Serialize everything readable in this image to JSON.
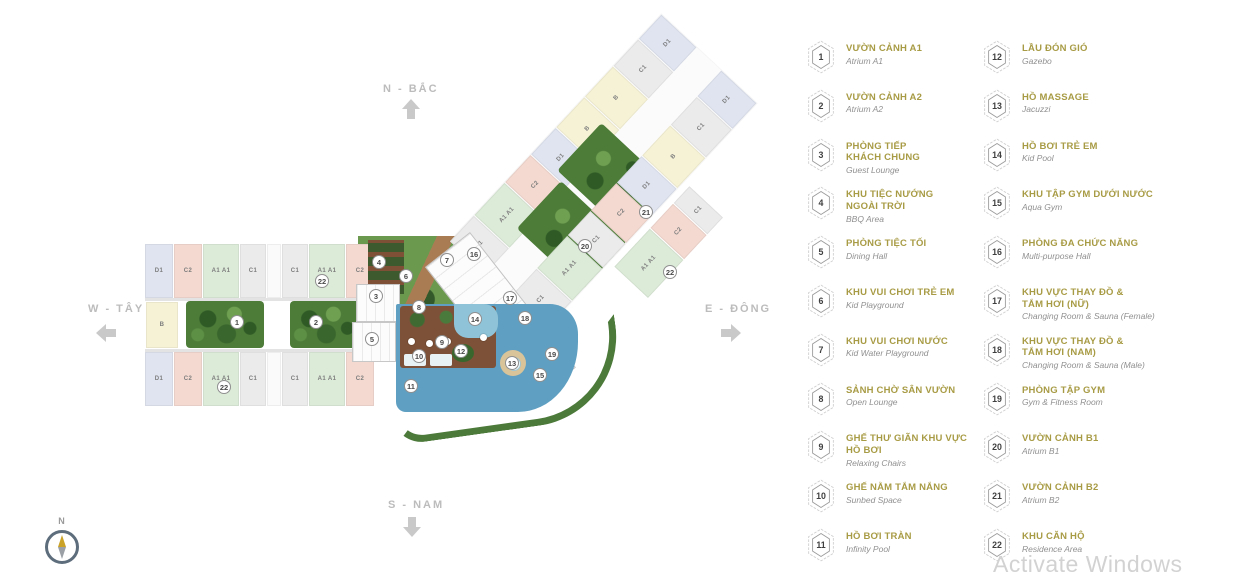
{
  "compass": {
    "north": "N - BẮC",
    "west": "W - TÂY",
    "east": "E - ĐÔNG",
    "south": "S - NAM",
    "rose_label": "N"
  },
  "watermark": {
    "text": "Activate Windows"
  },
  "colors": {
    "accent_gold": "#a89b45",
    "subtitle_gray": "#909090",
    "pool": "#5f9fc1",
    "pool_light": "#8fc3d8",
    "deck_brown": "#7d5137",
    "garden_green": "#6b9a4f",
    "courtyard_green": "#4d7c38",
    "unit_colors": {
      "mint": "#dcead8",
      "pink": "#f3d9d0",
      "gray": "#ebebeb",
      "lavender": "#dfe4f0",
      "yellow": "#f6f2d6",
      "white": "#fafafa"
    }
  },
  "plan": {
    "west_top_units": [
      {
        "l": "D1",
        "c": "lavender",
        "w": 28
      },
      {
        "l": "C2",
        "c": "pink",
        "w": 28
      },
      {
        "l": "A1 A1",
        "c": "mint",
        "w": 36
      },
      {
        "l": "C1",
        "c": "gray",
        "w": 26
      },
      {
        "l": "",
        "c": "white",
        "w": 14
      },
      {
        "l": "C1",
        "c": "gray",
        "w": 26
      },
      {
        "l": "A1 A1",
        "c": "mint",
        "w": 36
      },
      {
        "l": "C2",
        "c": "pink",
        "w": 28
      }
    ],
    "west_bottom_units": [
      {
        "l": "D1",
        "c": "lavender",
        "w": 28
      },
      {
        "l": "C2",
        "c": "pink",
        "w": 28
      },
      {
        "l": "A1 A1",
        "c": "mint",
        "w": 36
      },
      {
        "l": "C1",
        "c": "gray",
        "w": 26
      },
      {
        "l": "",
        "c": "white",
        "w": 14
      },
      {
        "l": "C1",
        "c": "gray",
        "w": 26
      },
      {
        "l": "A1 A1",
        "c": "mint",
        "w": 36
      },
      {
        "l": "C2",
        "c": "pink",
        "w": 28
      }
    ],
    "wing_top_units": [
      {
        "l": "C1",
        "c": "gray",
        "w": 36
      },
      {
        "l": "A1 A1",
        "c": "mint",
        "w": 44
      },
      {
        "l": "C2",
        "c": "pink",
        "w": 38
      },
      {
        "l": "D1",
        "c": "lavender",
        "w": 36
      },
      {
        "l": "B",
        "c": "yellow",
        "w": 42
      },
      {
        "l": "B",
        "c": "yellow",
        "w": 42
      },
      {
        "l": "C1",
        "c": "gray",
        "w": 36
      },
      {
        "l": "D1",
        "c": "lavender",
        "w": 34
      }
    ],
    "wing_bottom_units": [
      {
        "l": "C1",
        "c": "gray",
        "w": 40
      },
      {
        "l": "A1 A1",
        "c": "mint",
        "w": 44
      },
      {
        "l": "C1",
        "c": "gray",
        "w": 34
      },
      {
        "l": "C2",
        "c": "pink",
        "w": 38
      },
      {
        "l": "D1",
        "c": "lavender",
        "w": 36
      },
      {
        "l": "B",
        "c": "yellow",
        "w": 42
      },
      {
        "l": "C1",
        "c": "gray",
        "w": 38
      },
      {
        "l": "D1",
        "c": "lavender",
        "w": 36
      }
    ],
    "wing_extra_units": [
      {
        "l": "A1 A1",
        "c": "mint",
        "w": 52
      },
      {
        "l": "C2",
        "c": "pink",
        "w": 34
      },
      {
        "l": "C1",
        "c": "gray",
        "w": 23
      }
    ],
    "left_cap_label": "B",
    "markers": [
      {
        "n": "1",
        "x": 238,
        "y": 323
      },
      {
        "n": "2",
        "x": 317,
        "y": 323
      },
      {
        "n": "3",
        "x": 377,
        "y": 297
      },
      {
        "n": "4",
        "x": 380,
        "y": 263
      },
      {
        "n": "5",
        "x": 373,
        "y": 340
      },
      {
        "n": "6",
        "x": 407,
        "y": 277
      },
      {
        "n": "7",
        "x": 448,
        "y": 261
      },
      {
        "n": "8",
        "x": 420,
        "y": 308
      },
      {
        "n": "9",
        "x": 443,
        "y": 343
      },
      {
        "n": "10",
        "x": 420,
        "y": 357
      },
      {
        "n": "11",
        "x": 412,
        "y": 387
      },
      {
        "n": "12",
        "x": 462,
        "y": 352
      },
      {
        "n": "13",
        "x": 513,
        "y": 364
      },
      {
        "n": "14",
        "x": 476,
        "y": 320
      },
      {
        "n": "15",
        "x": 541,
        "y": 376
      },
      {
        "n": "16",
        "x": 475,
        "y": 255
      },
      {
        "n": "17",
        "x": 511,
        "y": 299
      },
      {
        "n": "18",
        "x": 526,
        "y": 319
      },
      {
        "n": "19",
        "x": 553,
        "y": 355
      },
      {
        "n": "20",
        "x": 586,
        "y": 247
      },
      {
        "n": "21",
        "x": 647,
        "y": 213
      },
      {
        "n": "22",
        "x": 323,
        "y": 282
      },
      {
        "n": "22",
        "x": 225,
        "y": 388
      },
      {
        "n": "22",
        "x": 671,
        "y": 273
      }
    ]
  },
  "legend": {
    "columns": [
      {
        "items": [
          {
            "num": "1",
            "title_lines": [
              "VƯỜN CẢNH A1"
            ],
            "subtitle": "Atrium A1"
          },
          {
            "num": "2",
            "title_lines": [
              "VƯỜN CẢNH A2"
            ],
            "subtitle": "Atrium A2"
          },
          {
            "num": "3",
            "title_lines": [
              "PHÒNG TIẾP",
              "KHÁCH CHUNG"
            ],
            "subtitle": "Guest Lounge"
          },
          {
            "num": "4",
            "title_lines": [
              "KHU TIỆC NƯỚNG",
              "NGOÀI TRỜI"
            ],
            "subtitle": "BBQ Area"
          },
          {
            "num": "5",
            "title_lines": [
              "PHÒNG TIỆC TỐI"
            ],
            "subtitle": "Dining Hall"
          },
          {
            "num": "6",
            "title_lines": [
              "KHU VUI CHƠI TRẺ EM"
            ],
            "subtitle": "Kid Playground"
          },
          {
            "num": "7",
            "title_lines": [
              "KHU VUI CHƠI NƯỚC"
            ],
            "subtitle": "Kid Water Playground"
          },
          {
            "num": "8",
            "title_lines": [
              "SẢNH CHỜ SÂN VƯỜN"
            ],
            "subtitle": "Open Lounge"
          },
          {
            "num": "9",
            "title_lines": [
              "GHẾ THƯ GIÃN KHU VỰC",
              "HỒ BƠI"
            ],
            "subtitle": "Relaxing Chairs"
          },
          {
            "num": "10",
            "title_lines": [
              "GHẾ NẰM TẮM NẮNG"
            ],
            "subtitle": "Sunbed Space"
          },
          {
            "num": "11",
            "title_lines": [
              "HỒ BƠI TRÀN"
            ],
            "subtitle": "Infinity Pool"
          }
        ]
      },
      {
        "items": [
          {
            "num": "12",
            "title_lines": [
              "LẦU ĐÓN GIÓ"
            ],
            "subtitle": "Gazebo"
          },
          {
            "num": "13",
            "title_lines": [
              "HỒ MASSAGE"
            ],
            "subtitle": "Jacuzzi"
          },
          {
            "num": "14",
            "title_lines": [
              "HỒ BƠI TRẺ EM"
            ],
            "subtitle": "Kid Pool"
          },
          {
            "num": "15",
            "title_lines": [
              "KHU TẬP GYM DƯỚI NƯỚC"
            ],
            "subtitle": "Aqua Gym"
          },
          {
            "num": "16",
            "title_lines": [
              "PHÒNG ĐA CHỨC NĂNG"
            ],
            "subtitle": "Multi-purpose Hall"
          },
          {
            "num": "17",
            "title_lines": [
              "KHU VỰC THAY ĐỒ &",
              "TẮM HƠI (NỮ)"
            ],
            "subtitle": "Changing Room & Sauna (Female)"
          },
          {
            "num": "18",
            "title_lines": [
              "KHU VỰC THAY ĐỒ &",
              "TẮM HƠI (NAM)"
            ],
            "subtitle": "Changing Room & Sauna (Male)"
          },
          {
            "num": "19",
            "title_lines": [
              "PHÒNG TẬP GYM"
            ],
            "subtitle": "Gym & Fitness Room"
          },
          {
            "num": "20",
            "title_lines": [
              "VƯỜN CẢNH B1"
            ],
            "subtitle": "Atrium B1"
          },
          {
            "num": "21",
            "title_lines": [
              "VƯỜN CẢNH B2"
            ],
            "subtitle": "Atrium B2"
          },
          {
            "num": "22",
            "title_lines": [
              "KHU CĂN HỘ"
            ],
            "subtitle": "Residence Area"
          }
        ]
      }
    ]
  }
}
